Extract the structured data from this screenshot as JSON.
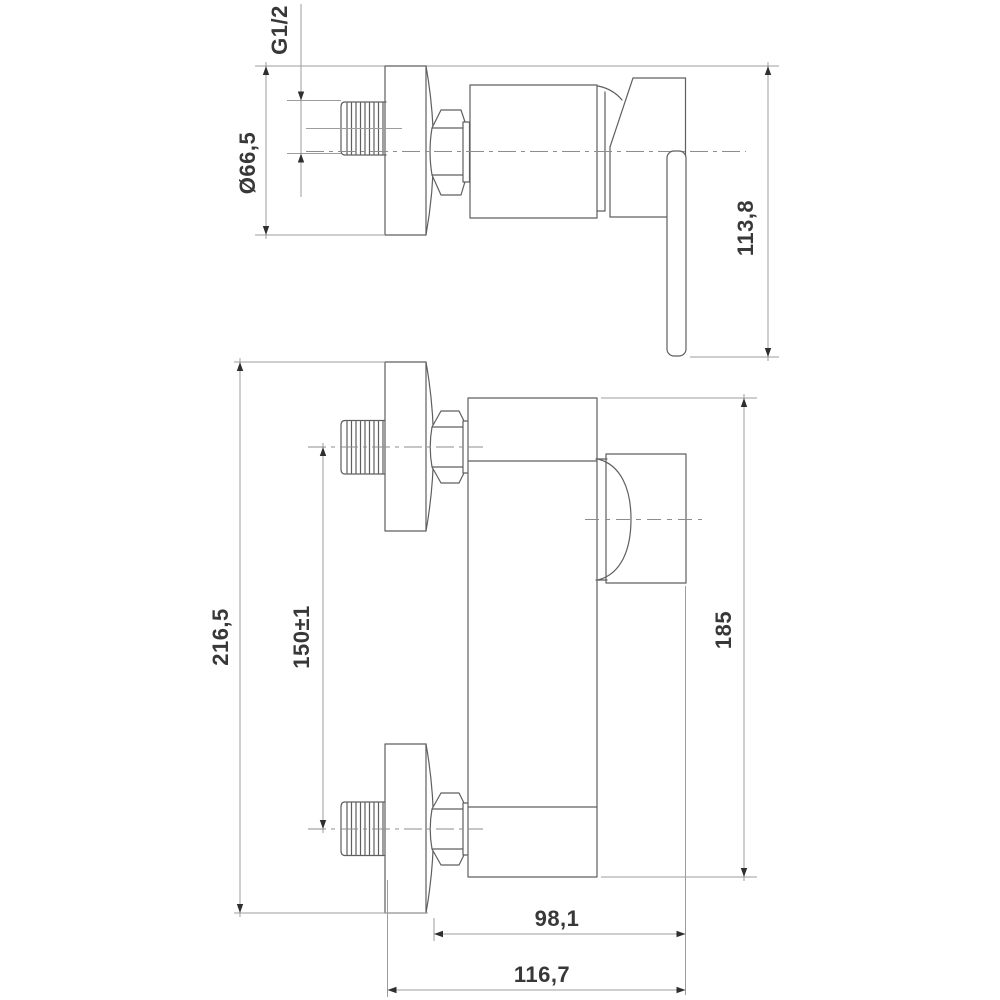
{
  "drawing": {
    "background_color": "#ffffff",
    "part_line_color": "#5f5f5f",
    "dimension_line_color": "#9d9d9d",
    "text_color": "#383838",
    "labels": {
      "thread_size": "G1/2",
      "flange_diameter": "Ø66,5",
      "fitting_height": "113,8",
      "overall_height": "216,5",
      "inlet_spacing": "150±1",
      "body_height": "185",
      "depth_to_flange_face": "98,1",
      "overall_depth": "116,7"
    }
  }
}
